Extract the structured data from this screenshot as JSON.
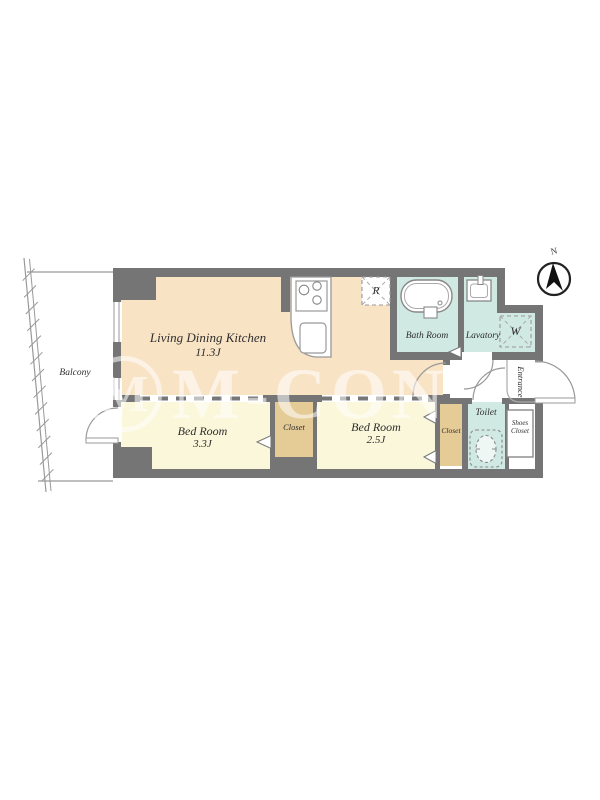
{
  "page": {
    "background": "#ffffff"
  },
  "plan": {
    "compass": {
      "north_label": "N"
    },
    "watermark": {
      "circled_letter": "M",
      "text": "M-CON"
    },
    "rooms": {
      "living_dining_kitchen": {
        "name": "Living Dining Kitchen",
        "size": "11.3J"
      },
      "bedroom_1": {
        "name": "Bed Room",
        "size": "3.3J"
      },
      "bedroom_2": {
        "name": "Bed Room",
        "size": "2.5J"
      },
      "bathroom": {
        "name": "Bath Room"
      },
      "lavatory": {
        "name": "Lavatory"
      },
      "toilet": {
        "name": "Toilet"
      },
      "closet_1": {
        "name": "Closet"
      },
      "closet_2": {
        "name": "Closet"
      },
      "shoes_closet": {
        "line1": "Shoes",
        "line2": "Closet"
      },
      "balcony": {
        "name": "Balcony"
      },
      "entrance": {
        "name": "Entrance"
      }
    },
    "appliances": {
      "refrigerator": "R",
      "washing_machine": "W"
    },
    "colors": {
      "wall": "#757575",
      "ldk_floor": "#f9e3c5",
      "bedroom_floor": "#fbf7da",
      "closet_floor": "#e5cb96",
      "wetroom_floor": "#d0e9e3",
      "line": "#999999",
      "text": "#2e2e2e",
      "watermark": "rgba(255,255,255,0.55)"
    }
  }
}
